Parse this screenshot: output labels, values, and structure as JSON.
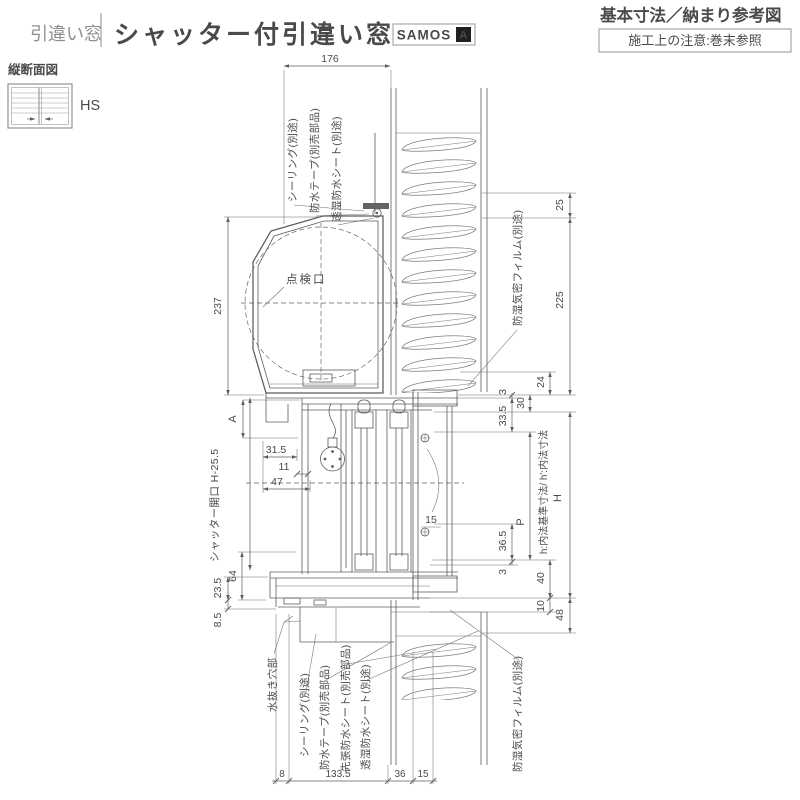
{
  "header": {
    "category": "引違い窓",
    "title": "シャッター付引違い窓",
    "badge": {
      "name": "SAMOS",
      "mark": "A"
    },
    "subtitle": "基本寸法／納まり参考図",
    "note": "施工上の注意:巻末参照"
  },
  "sidebar": {
    "section_label": "縦断面図",
    "code": "HS"
  },
  "drawing": {
    "annotations": {
      "seal_top": "シーリング(別途)",
      "tape_top": "防水テープ(別売部品)",
      "sheet_top": "透湿防水シート(別途)",
      "film_top": "防湿気密フィルム(別途)",
      "inspection_port": "点検口",
      "shutter_opening": "シャッター開口 H-25.5",
      "section_mark": "A",
      "drain_hole": "水抜き穴部",
      "seal_bottom": "シーリング(別途)",
      "tape_bottom": "防水テープ(別売部品)",
      "pre_waterproof_sheet": "先張防水シート(別売部品)",
      "sheet_bottom": "透湿防水シート(別途)",
      "film_bottom": "防湿気密フィルム(別途)",
      "inner_dim_note": "h:内法基準寸法/ h':内法寸法",
      "height_mark": "H",
      "pitch_mark": "P"
    },
    "dims": {
      "top_width": "176",
      "box_height": "237",
      "d31_5": "31.5",
      "d11": "11",
      "d47": "47",
      "d15": "15",
      "d64": "64",
      "d23_5": "23.5",
      "d8_5": "8.5",
      "r25": "25",
      "r225": "225",
      "r24": "24",
      "r30": "30",
      "r3_top": "3",
      "r33_5": "33.5",
      "r36_5": "36.5",
      "r3_bottom": "3",
      "r40": "40",
      "r10": "10",
      "r48": "48",
      "b8": "8",
      "b133_5": "133.5",
      "b36": "36",
      "b15": "15"
    }
  },
  "colors": {
    "line": "#5c5c5c",
    "text": "#4a4a4a",
    "muted_text": "#8f8f8f",
    "badge_fill": "#1f1f1f"
  }
}
